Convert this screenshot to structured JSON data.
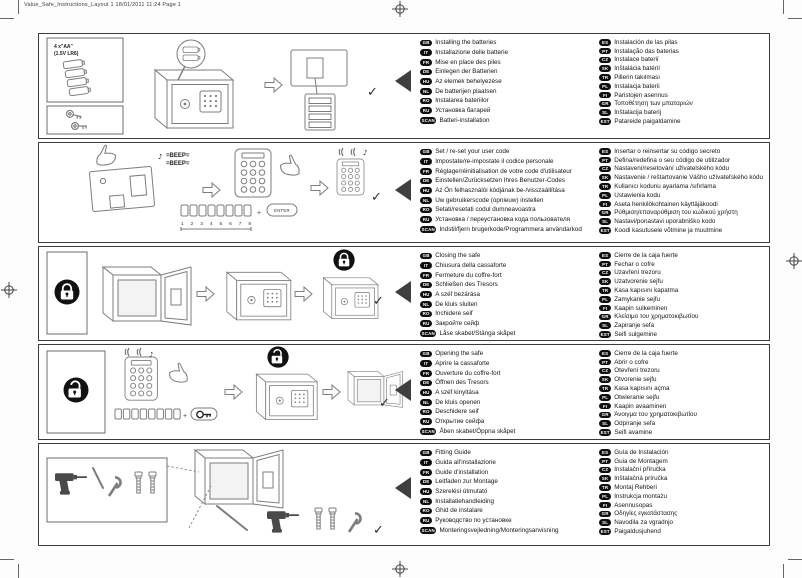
{
  "page": {
    "header": "Value_Safe_Instructions_Layout 1  18/01/2011  11:24  Page 1"
  },
  "graphics": {
    "battery_spec_1": "4 x\"AA\"",
    "battery_spec_2": "(1.5V LR6)",
    "note": "♪",
    "beep_line1": "=BEEP=",
    "beep_line2": "=BEEP=",
    "digits": "1 2 3 4 5 6 7 8",
    "enter": "ENTER",
    "check": "✓"
  },
  "sections": [
    {
      "id": "installing-batteries",
      "left": [
        {
          "code": "GB",
          "text": "Installing the batteries"
        },
        {
          "code": "IT",
          "text": "Installazione delle batterie"
        },
        {
          "code": "FR",
          "text": "Mise en place des piles"
        },
        {
          "code": "DE",
          "text": "Einlegen der Batterien"
        },
        {
          "code": "HU",
          "text": "Az elemek behelyezése"
        },
        {
          "code": "NL",
          "text": "De batterijen plaatsen"
        },
        {
          "code": "RO",
          "text": "Instalarea bateriilor"
        },
        {
          "code": "RU",
          "text": "Установка батарей"
        },
        {
          "code": "SCAN",
          "text": "Batteri-installation"
        }
      ],
      "right": [
        {
          "code": "ES",
          "text": "Instalación de las pilas"
        },
        {
          "code": "PT",
          "text": "Instalação das baterias"
        },
        {
          "code": "CZ",
          "text": "Instalace baterií"
        },
        {
          "code": "SK",
          "text": "Inštalácia batérií"
        },
        {
          "code": "TR",
          "text": "Pillerin takılması"
        },
        {
          "code": "PL",
          "text": "Instalacja baterii"
        },
        {
          "code": "FI",
          "text": "Paristojen asennus"
        },
        {
          "code": "GR",
          "text": "Τοποθέτηση των μπαταριών"
        },
        {
          "code": "SL",
          "text": "Inštalacija baterij"
        },
        {
          "code": "EST",
          "text": "Patareide paigaldamine"
        }
      ]
    },
    {
      "id": "set-user-code",
      "left": [
        {
          "code": "GB",
          "text": "Set / re-set your user code"
        },
        {
          "code": "IT",
          "text": "Impostate/re-impostate il codice personale"
        },
        {
          "code": "FR",
          "text": "Réglage/réinitialisation de votre code d'utilisateur"
        },
        {
          "code": "DE",
          "text": "Einstellen/Zurücksetzen Ihres Benutzer-Codes"
        },
        {
          "code": "HU",
          "text": "Az Ön felhasználói kódjának be-/visszaállítása"
        },
        {
          "code": "NL",
          "text": "Uw gebruikerscode (opnieuw) instellen"
        },
        {
          "code": "RO",
          "text": "Setati/resetati codul dumneavoastra"
        },
        {
          "code": "RU",
          "text": "Установка / переустановка кода пользователя"
        },
        {
          "code": "SCAN",
          "text": "Indstil/fjern brugerkode/Programmera användarkod"
        }
      ],
      "right": [
        {
          "code": "ES",
          "text": "Insertar o reinsertar su código secreto"
        },
        {
          "code": "PT",
          "text": "Defina/redefina o seu código de utilizador"
        },
        {
          "code": "CZ",
          "text": "Nastavení/resetování uživatelského kódu"
        },
        {
          "code": "SK",
          "text": "Nastavenie / reštartovanie Vášho užívateľského kódu"
        },
        {
          "code": "TR",
          "text": "Kullanıcı kodunu ayarlama /sıfırlama"
        },
        {
          "code": "PL",
          "text": "Ustawienia kodu"
        },
        {
          "code": "FI",
          "text": "Aseta henkilökohtainen käyttäjäkoodi"
        },
        {
          "code": "GR",
          "text": "Ρύθμιση/επαναρύθμιση του κωδικού χρήστη"
        },
        {
          "code": "SL",
          "text": "Nastavi/ponastavi uporabniško kodo"
        },
        {
          "code": "EST",
          "text": "Koodi kasutusele võtmine ja muutmine"
        }
      ]
    },
    {
      "id": "closing-the-safe",
      "left": [
        {
          "code": "GB",
          "text": "Closing the safe"
        },
        {
          "code": "IT",
          "text": "Chiusura della cassaforte"
        },
        {
          "code": "FR",
          "text": "Fermeture du coffre-fort"
        },
        {
          "code": "DE",
          "text": "Schließen des Tresors"
        },
        {
          "code": "HU",
          "text": "A széf bezárása"
        },
        {
          "code": "NL",
          "text": "De kluis sluiten"
        },
        {
          "code": "RO",
          "text": "Inchidere seif"
        },
        {
          "code": "RU",
          "text": "Закройте сейф"
        },
        {
          "code": "SCAN",
          "text": "Låse skabet/Stänga skåpet"
        }
      ],
      "right": [
        {
          "code": "ES",
          "text": "Cierre de la caja fuerte"
        },
        {
          "code": "PT",
          "text": "Fechar o cofre"
        },
        {
          "code": "CZ",
          "text": "Uzavření trezoru"
        },
        {
          "code": "SK",
          "text": "Uzatvorenie sejfu"
        },
        {
          "code": "TR",
          "text": "Kasa kapısını kapatma"
        },
        {
          "code": "PL",
          "text": "Zamykanie sejfu"
        },
        {
          "code": "FI",
          "text": "Kaapin sulkeminen"
        },
        {
          "code": "GR",
          "text": "Κλείσιμο του χρηματοκιβωτίου"
        },
        {
          "code": "SL",
          "text": "Zapiranje sefa"
        },
        {
          "code": "EST",
          "text": "Seifi sulgemine"
        }
      ]
    },
    {
      "id": "opening-the-safe",
      "left": [
        {
          "code": "GB",
          "text": "Opening the safe"
        },
        {
          "code": "IT",
          "text": "Aprire la cassaforte"
        },
        {
          "code": "FR",
          "text": "Ouverture du coffre-fort"
        },
        {
          "code": "DE",
          "text": "Öffnen des Tresors"
        },
        {
          "code": "HU",
          "text": "A széf kinyitása"
        },
        {
          "code": "NL",
          "text": "De kluis openen"
        },
        {
          "code": "RO",
          "text": "Deschidere seif"
        },
        {
          "code": "RU",
          "text": "Открытие сейфа"
        },
        {
          "code": "SCAN",
          "text": "Åben skabet/Öppna skåpet"
        }
      ],
      "right": [
        {
          "code": "ES",
          "text": "Cierre de la caja fuerte"
        },
        {
          "code": "PT",
          "text": "Abrir o cofre"
        },
        {
          "code": "CZ",
          "text": "Otevření trezoru"
        },
        {
          "code": "SK",
          "text": "Otvorenie sejfu"
        },
        {
          "code": "TR",
          "text": "Kasa kapısını açma"
        },
        {
          "code": "PL",
          "text": "Otwieranie sejfu"
        },
        {
          "code": "FI",
          "text": "Kaapin avaaminen"
        },
        {
          "code": "GR",
          "text": "Άνοιγμα του χρηματοκιβωτίου"
        },
        {
          "code": "SL",
          "text": "Odpiranje sefa"
        },
        {
          "code": "EST",
          "text": "Seifi avamine"
        }
      ]
    },
    {
      "id": "fitting-guide",
      "left": [
        {
          "code": "GB",
          "text": "Fitting Guide"
        },
        {
          "code": "IT",
          "text": "Guida all'installazione"
        },
        {
          "code": "FR",
          "text": "Guide d'installation"
        },
        {
          "code": "DE",
          "text": "Leitfaden zur Montage"
        },
        {
          "code": "HU",
          "text": "Szerelési útmutató"
        },
        {
          "code": "NL",
          "text": "Installatiehandleiding"
        },
        {
          "code": "RO",
          "text": "Ghid de instalare"
        },
        {
          "code": "RU",
          "text": "Руководство по установке"
        },
        {
          "code": "SCAN",
          "text": "Monteringsvejledning/Monteringsanvisning"
        }
      ],
      "right": [
        {
          "code": "ES",
          "text": "Guía de Instalación"
        },
        {
          "code": "PT",
          "text": "Guia de Montagem"
        },
        {
          "code": "CZ",
          "text": "Instalační příručka"
        },
        {
          "code": "SK",
          "text": "Inštalačná príručka"
        },
        {
          "code": "TR",
          "text": "Montaj Rehberi"
        },
        {
          "code": "PL",
          "text": "Instrukcja montażu"
        },
        {
          "code": "FI",
          "text": "Asennusopas"
        },
        {
          "code": "GR",
          "text": "Οδηγίες εγκατάστασης"
        },
        {
          "code": "SL",
          "text": "Navodila za vgradnjo"
        },
        {
          "code": "EST",
          "text": "Paigaldusjuhend"
        }
      ]
    }
  ]
}
